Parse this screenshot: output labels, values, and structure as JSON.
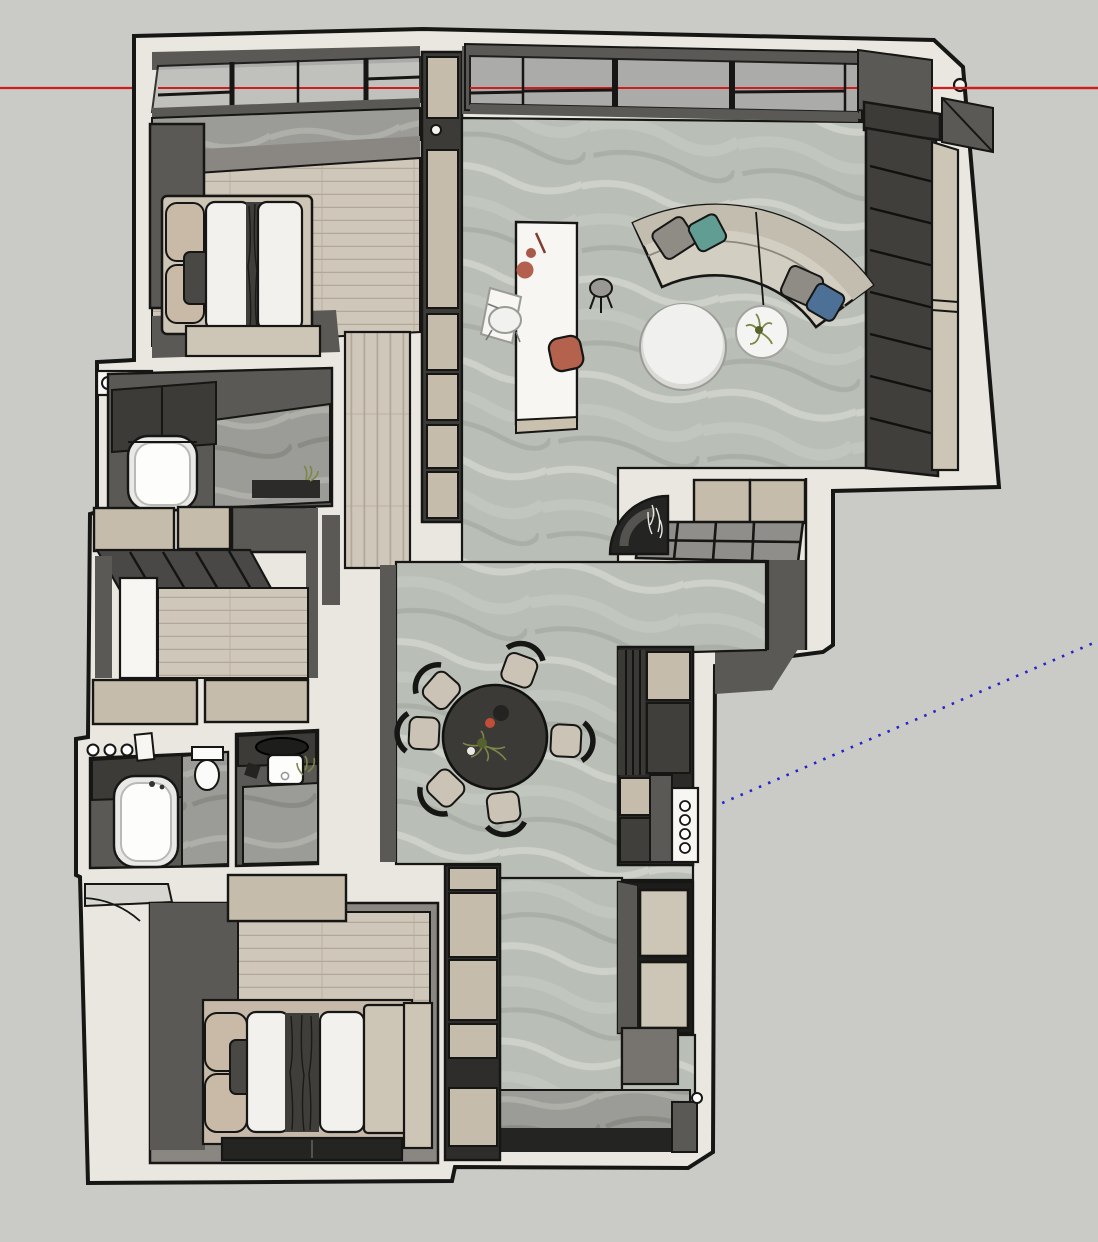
{
  "viewport": {
    "description": "3D architectural model viewport, top-down perspective of an apartment floor plan",
    "width": 1098,
    "height": 1242
  },
  "axes": {
    "red": {
      "name": "red-axis",
      "color": "#cf1d1d",
      "style": "solid",
      "y": 88
    },
    "blue": {
      "name": "blue-axis",
      "color": "#2222cf",
      "style": "dotted",
      "from": [
        713,
        807
      ],
      "to": [
        1098,
        641
      ]
    }
  },
  "colors": {
    "background": "#cacac6",
    "line": "#161614",
    "wallWhite": "#eae7e0",
    "wallDark": "#5b5955",
    "wallDarker": "#3c3b38",
    "wallMid": "#8a8783",
    "marbleBase": "#b9beb6",
    "woodBase": "#cfc7b9",
    "woodLine": "#b1a89a",
    "beigePanel": "#c5bcab",
    "beigeSoft": "#cdc5b5",
    "furnWhite": "#f7f6f3",
    "furnBlack": "#242422",
    "sofaBeige": "#d3cec2",
    "sofaShade": "#c3bdaf",
    "pillowTeal": "#619d93",
    "pillowBlue": "#4d7097",
    "pillowGray": "#8f8c85",
    "terracotta": "#b4614e",
    "tableDark": "#3b3a37",
    "chairSeat": "#cbc4b6",
    "rug": "#c6b9aa",
    "counterGray": "#908e8a",
    "glass": "#b9bab8",
    "plantGreen": "#7c8748",
    "plantDark": "#55622e"
  },
  "scene": {
    "rooms": [
      {
        "name": "master-bedroom",
        "floor": "wood"
      },
      {
        "name": "living-room",
        "floor": "marble"
      },
      {
        "name": "dining-area",
        "floor": "marble"
      },
      {
        "name": "bathroom-top",
        "floor": "marble"
      },
      {
        "name": "walk-in-closet",
        "floor": "wood"
      },
      {
        "name": "bathroom-bottom",
        "floor": "marble"
      },
      {
        "name": "second-bedroom",
        "floor": "wood"
      },
      {
        "name": "entry-hall",
        "floor": "marble"
      }
    ],
    "furniture": [
      "double-bed",
      "wardrobe",
      "curved-sofa",
      "coffee-table",
      "side-table",
      "kitchen-island",
      "bar-stool",
      "dining-table",
      "dining-chairs",
      "bathtub",
      "toilet",
      "vanity-sink",
      "tv-console",
      "oven-column",
      "entry-shelf"
    ],
    "dining_chair_angles_deg": [
      3,
      83,
      134,
      183,
      221,
      290
    ]
  }
}
